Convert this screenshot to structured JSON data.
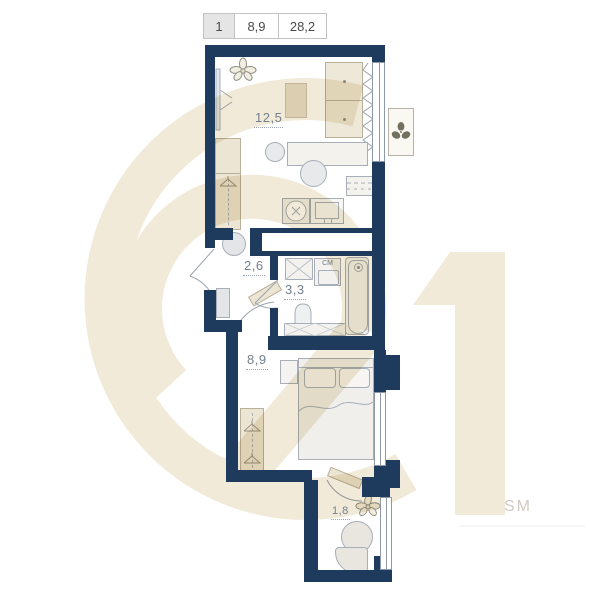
{
  "header": {
    "columns": [
      "1",
      "8,9",
      "28,2"
    ]
  },
  "plan": {
    "rooms": [
      {
        "name": "living-room",
        "area": "12,5"
      },
      {
        "name": "hallway",
        "area": "2,6"
      },
      {
        "name": "bathroom",
        "area": "3,3"
      },
      {
        "name": "bedroom",
        "area": "8,9"
      },
      {
        "name": "balcony",
        "area": "1,8"
      }
    ],
    "appliances": {
      "washing_machine": "СМ"
    }
  },
  "watermark": {
    "number": "21",
    "text": "SM"
  },
  "colors": {
    "wall": "#1e3a5c",
    "furniture_beige": "#ece5d4",
    "watermark_beige": "#f1ead9",
    "label": "#74808c"
  }
}
